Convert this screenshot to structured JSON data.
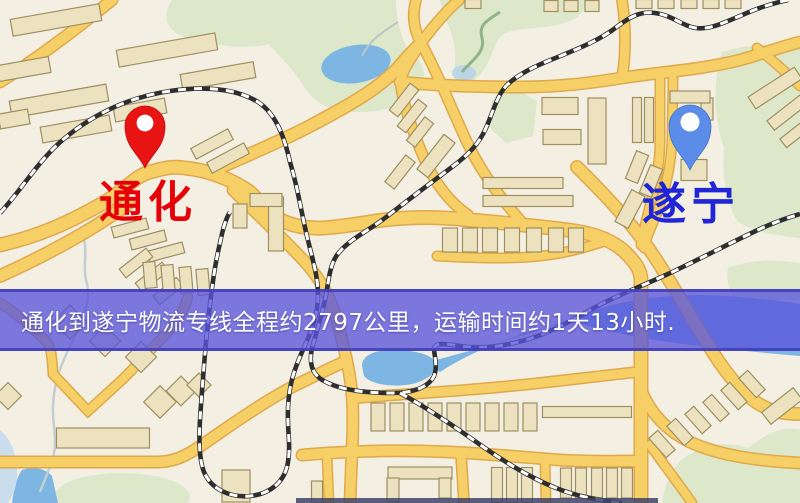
{
  "pins": {
    "origin": {
      "label": "通化",
      "pin_color": "#e81313",
      "label_color": "#e60008"
    },
    "destination": {
      "label": "遂宁",
      "pin_color": "#5b8de8",
      "label_color": "#2026d6"
    }
  },
  "banner": {
    "text": "通化到遂宁物流专线全程约2797公里，运输时间约1天13小时.",
    "background_rgba": "rgba(88,84,219,0.78)",
    "edge_color": "rgba(64,60,185,0.85)",
    "text_color": "#ffffff",
    "origin": "通化",
    "destination": "遂宁",
    "distance_km": "2797",
    "duration": "1天13小时"
  },
  "map_colors": {
    "background": "#f4efe3",
    "road_fill": "#f6cf66",
    "road_casing": "#dfa94c",
    "building_fill": "#ece2bf",
    "building_stroke": "#9d8f60",
    "park_green": "#dce8c9",
    "water_blue": "#7db6e2",
    "water_pale": "#c9dded",
    "railway_dark": "#2e2e2e",
    "railway_light": "#ffffff"
  }
}
